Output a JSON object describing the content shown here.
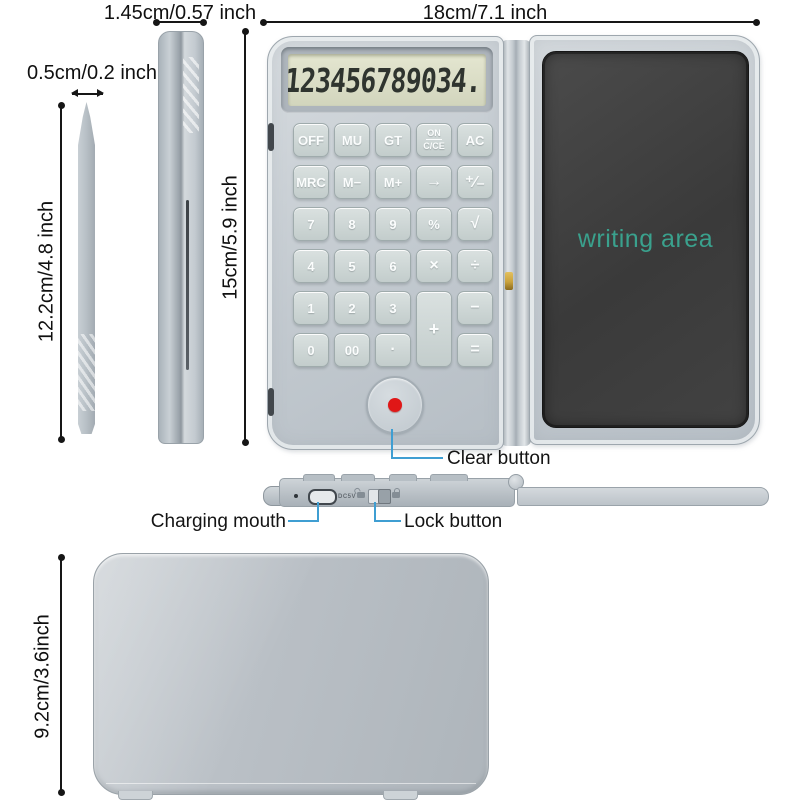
{
  "labels": {
    "folded_thickness": "1.45cm/0.57 inch",
    "stylus_width": "0.5cm/0.2 inch",
    "open_width": "18cm/7.1 inch",
    "stylus_length": "12.2cm/4.8 inch",
    "open_height": "15cm/5.9 inch",
    "folded_height": "9.2cm/3.6inch",
    "clear_button": "Clear button",
    "charging_mouth": "Charging mouth",
    "lock_button": "Lock button"
  },
  "calculator": {
    "display_value": "123456789034.",
    "keys": [
      {
        "id": "off",
        "label": "OFF",
        "col": 1,
        "row": 1
      },
      {
        "id": "mu",
        "label": "MU",
        "col": 2,
        "row": 1
      },
      {
        "id": "gt",
        "label": "GT",
        "col": 3,
        "row": 1
      },
      {
        "id": "on-cce",
        "label": "ON",
        "label2": "C/CE",
        "col": 4,
        "row": 1
      },
      {
        "id": "ac",
        "label": "AC",
        "col": 5,
        "row": 1
      },
      {
        "id": "mrc",
        "label": "MRC",
        "col": 1,
        "row": 2
      },
      {
        "id": "m-minus",
        "label": "M−",
        "col": 2,
        "row": 2
      },
      {
        "id": "m-plus",
        "label": "M+",
        "col": 3,
        "row": 2
      },
      {
        "id": "backspace",
        "label": "→",
        "col": 4,
        "row": 2,
        "op": true
      },
      {
        "id": "plus-minus",
        "label": "⁺∕₋",
        "col": 5,
        "row": 2,
        "op": true
      },
      {
        "id": "7",
        "label": "7",
        "col": 1,
        "row": 3
      },
      {
        "id": "8",
        "label": "8",
        "col": 2,
        "row": 3
      },
      {
        "id": "9",
        "label": "9",
        "col": 3,
        "row": 3
      },
      {
        "id": "percent",
        "label": "%",
        "col": 4,
        "row": 3
      },
      {
        "id": "sqrt",
        "label": "√",
        "col": 5,
        "row": 3,
        "op": true
      },
      {
        "id": "4",
        "label": "4",
        "col": 1,
        "row": 4
      },
      {
        "id": "5",
        "label": "5",
        "col": 2,
        "row": 4
      },
      {
        "id": "6",
        "label": "6",
        "col": 3,
        "row": 4
      },
      {
        "id": "multiply",
        "label": "×",
        "col": 4,
        "row": 4,
        "op": true
      },
      {
        "id": "divide",
        "label": "÷",
        "col": 5,
        "row": 4,
        "op": true
      },
      {
        "id": "1",
        "label": "1",
        "col": 1,
        "row": 5
      },
      {
        "id": "2",
        "label": "2",
        "col": 2,
        "row": 5
      },
      {
        "id": "3",
        "label": "3",
        "col": 3,
        "row": 5
      },
      {
        "id": "plus",
        "label": "+",
        "col": 4,
        "row": 5,
        "rowspan": 2,
        "op": true
      },
      {
        "id": "minus",
        "label": "−",
        "col": 5,
        "row": 5,
        "op": true
      },
      {
        "id": "0",
        "label": "0",
        "col": 1,
        "row": 6
      },
      {
        "id": "00",
        "label": "00",
        "col": 2,
        "row": 6
      },
      {
        "id": "decimal",
        "label": "·",
        "col": 3,
        "row": 6,
        "op": true
      },
      {
        "id": "equals",
        "label": "=",
        "col": 5,
        "row": 6,
        "op": true
      }
    ]
  },
  "tablet": {
    "writing_area_label": "writing area"
  },
  "side_view": {
    "dc_label": "DC5V"
  },
  "colors": {
    "callout_blue": "#3f9ed2",
    "writing_teal": "#3aa18d",
    "clear_red": "#e01717",
    "hinge_gold": "#c9a23c",
    "dimension_black": "#161616"
  }
}
